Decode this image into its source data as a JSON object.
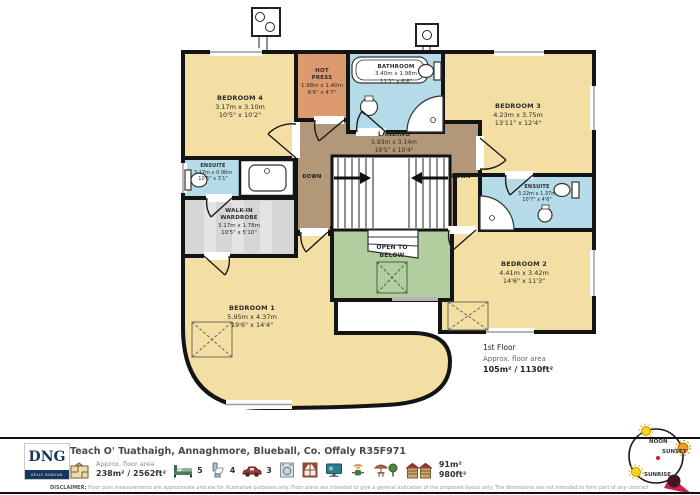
{
  "rooms": {
    "bedroom4": {
      "name": "BEDROOM 4",
      "metric": "3.17m  x 3.10m",
      "imperial": "10'5\"  x 10'2\""
    },
    "hot_press": {
      "name": "HOT PRESS",
      "metric": "1.98m  x 1.40m",
      "imperial": "6'6\"  x 4'7\""
    },
    "bathroom": {
      "name": "BATHROOM",
      "metric": "3.40m  x 1.98m",
      "imperial": "11'2\"  x 6'6\""
    },
    "bedroom3": {
      "name": "BEDROOM 3",
      "metric": "4.23m  x 3.75m",
      "imperial": "13'11\"  x 12'4\""
    },
    "landing": {
      "name": "LANDING",
      "metric": "5.93m  x 3.14m",
      "imperial": "19'5\"  x 10'4\""
    },
    "ensuite_left": {
      "name": "ENSUITE",
      "metric": "3.17m  x 0.96m",
      "imperial": "10'5\"  x 3'1\""
    },
    "wardrobe": {
      "name": "WALK-IN WARDROBE",
      "metric": "3.17m  x 1.78m",
      "imperial": "10'5\"  x 5'10\""
    },
    "open_below": {
      "name": "OPEN TO BELOW"
    },
    "ensuite_right": {
      "name": "ENSUITE",
      "metric": "3.22m  x 1.37m",
      "imperial": "10'7\"  x 4'6\""
    },
    "bedroom2": {
      "name": "BEDROOM 2",
      "metric": "4.41m  x 3.42m",
      "imperial": "14'6\"  x 11'3\""
    },
    "bedroom1": {
      "name": "BEDROOM 1",
      "metric": "5.95m  x 4.37m",
      "imperial": "19'6\"  x 14'4\""
    },
    "down_label": "DOWN"
  },
  "floor_info": {
    "title": "1st Floor",
    "area_label": "Approx. floor area",
    "area_value": "105m² / 1130ft²"
  },
  "compass": {
    "noon": "NOON",
    "sunset": "SUNSET",
    "sunrise": "SUNRISE"
  },
  "footer": {
    "logo": {
      "name": "DNG",
      "sub": "KELLY DUNCAN"
    },
    "address": "Teach O' Tuathaigh, Annaghmore, Blueball, Co. Offaly R35F971",
    "floor_area_label": "Approx. floor area",
    "floor_area_value": "238m² / 2562ft²",
    "beds": "5",
    "bathrooms": "4",
    "parking": "3",
    "outdoor_area_m": "91m²",
    "outdoor_area_ft": "980ft²",
    "disclaimer_label": "DISCLAIMER:",
    "disclaimer": "Floor plan measurements are approximate and are for illustrative purposes only. Floor plans are intended to give a general indication of the proposed layout only. The dimensions are not intended to form part of any contract or warranty"
  },
  "colors": {
    "room_cream": "#f3dfa4",
    "wet_blue": "#b4dbe7",
    "hall_brown": "#b29878",
    "open_green": "#b2cd9e",
    "hot_press_tan": "#dd9a6f",
    "wall": "#141414",
    "dng_navy": "#16355f"
  }
}
